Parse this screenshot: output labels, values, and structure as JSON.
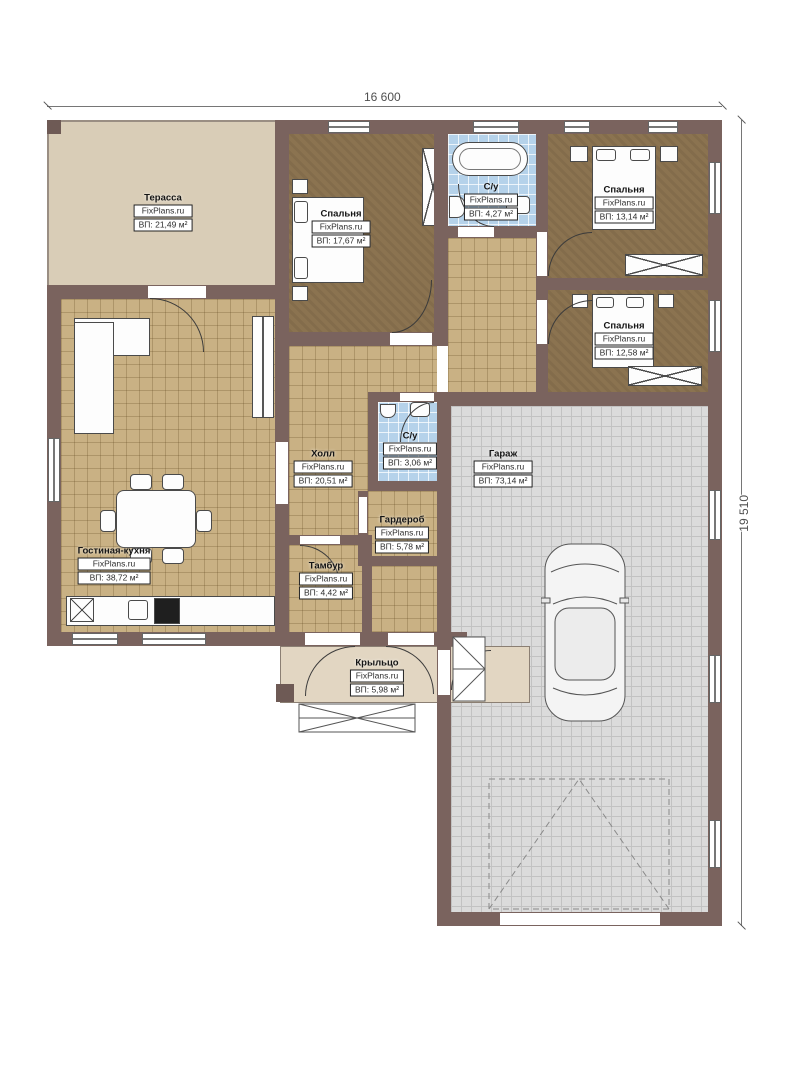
{
  "plan": {
    "brand": "FixPlans.ru",
    "dimensions": {
      "width_label": "16 600",
      "height_label": "19 510"
    },
    "rooms": [
      {
        "id": "terrace",
        "name": "Терасса",
        "area": "ВП: 21,49 м²"
      },
      {
        "id": "bedroom1",
        "name": "Спальня",
        "area": "ВП: 17,67 м²"
      },
      {
        "id": "bath1",
        "name": "С/у",
        "area": "ВП: 4,27 м²"
      },
      {
        "id": "bedroom2",
        "name": "Спальня",
        "area": "ВП: 13,14 м²"
      },
      {
        "id": "bedroom3",
        "name": "Спальня",
        "area": "ВП: 12,58 м²"
      },
      {
        "id": "bath2",
        "name": "С/у",
        "area": "ВП: 3,06 м²"
      },
      {
        "id": "hall",
        "name": "Холл",
        "area": "ВП: 20,51 м²"
      },
      {
        "id": "garage",
        "name": "Гараж",
        "area": "ВП: 73,14 м²"
      },
      {
        "id": "wardrobe",
        "name": "Гардероб",
        "area": "ВП: 5,78 м²"
      },
      {
        "id": "living",
        "name": "Гостиная-кухня",
        "area": "ВП: 38,72 м²"
      },
      {
        "id": "vestibule",
        "name": "Тамбур",
        "area": "ВП: 4,42 м²"
      },
      {
        "id": "porch",
        "name": "Крыльцо",
        "area": "ВП: 5,98 м²"
      }
    ],
    "colors": {
      "wall": "#7a635e",
      "floor_tile_beige": "#c9b184",
      "floor_bathroom_blue": "#b5d2ea",
      "floor_garage_gray": "#dbdbdb",
      "floor_bedroom_brown": "#8b7350",
      "terrace": "#d9cdb7",
      "porch": "#e2d6c2"
    }
  }
}
